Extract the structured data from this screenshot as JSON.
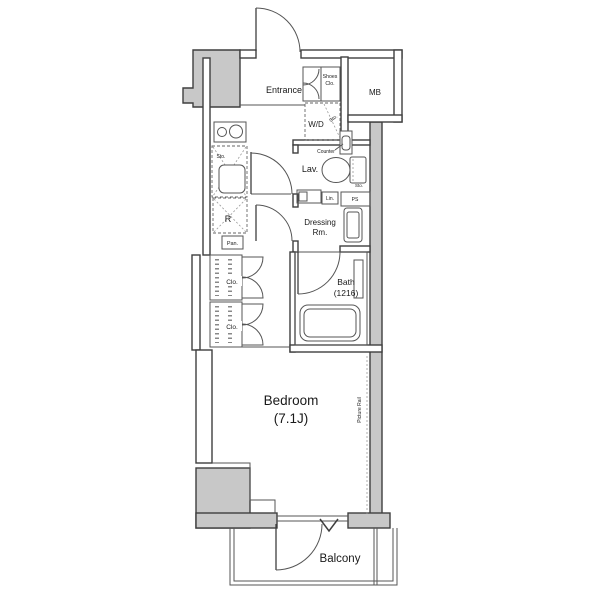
{
  "plan": {
    "type": "apartment-floor-plan",
    "labels": {
      "entrance": "Entrance",
      "shoes_line1": "Shoes",
      "shoes_line2": "Clo.",
      "mb": "MB",
      "wd": "W/D",
      "wd_sto": "Sto.",
      "kitchen_sto": "Sto.",
      "fridge": "R",
      "pantry": "Pan.",
      "lav": "Lav.",
      "counter": "Counter",
      "toilet_sto": "Sto.",
      "linen": "Lin.",
      "pipe_space": "PS",
      "dressing_line1": "Dressing",
      "dressing_line2": "Rm.",
      "bath_line1": "Bath",
      "bath_line2": "(1216)",
      "closet_upper": "Clo.",
      "closet_lower": "Clo.",
      "bedroom_line1": "Bedroom",
      "bedroom_line2": "(7.1J)",
      "picture_rail": "Picture Rail",
      "balcony": "Balcony"
    },
    "colors": {
      "background": "#ffffff",
      "wall_outline": "#3f3f3f",
      "wall_fill": "#c8c8c8",
      "fixture_line": "#555555",
      "text": "#1a1a1a"
    }
  }
}
